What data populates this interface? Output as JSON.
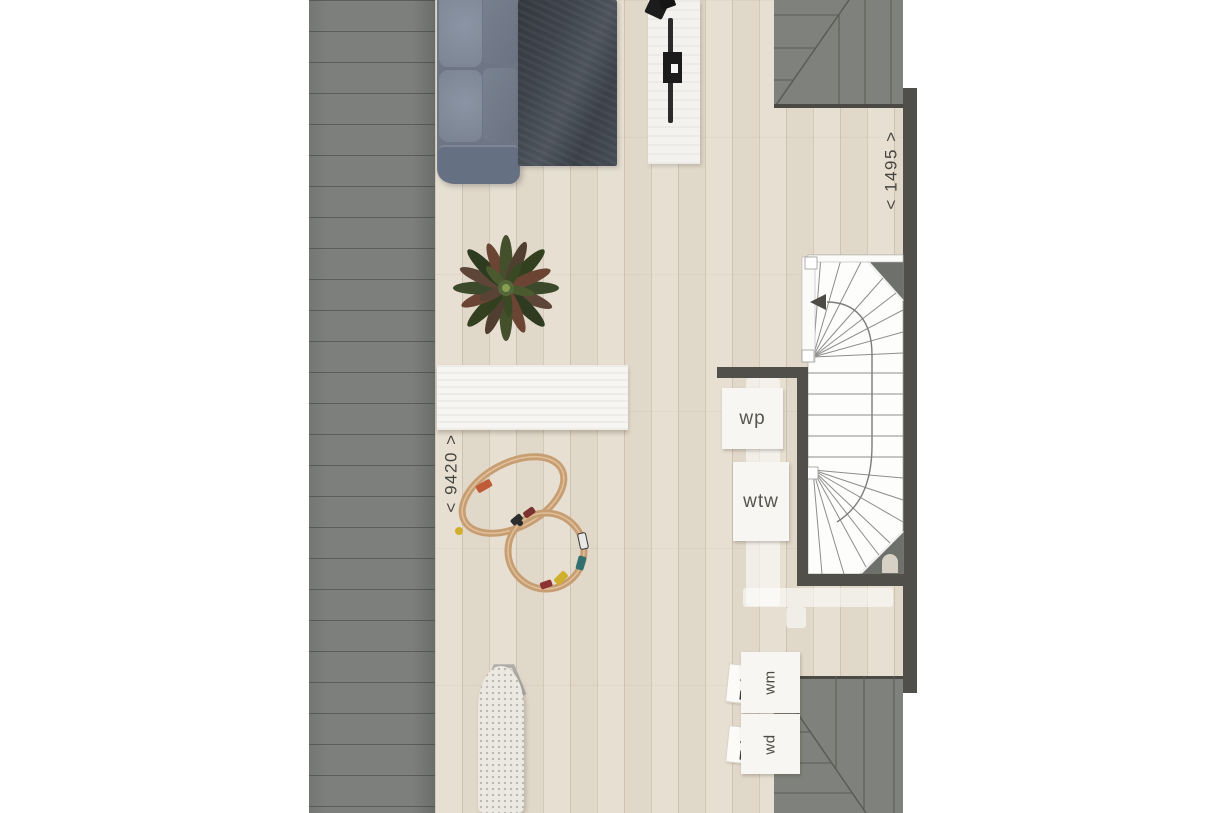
{
  "plan": {
    "dimension_labels": {
      "width": "< 9420 >",
      "depth": "< 1495 >"
    },
    "unit_labels": {
      "wp": "wp",
      "wtw": "wtw",
      "wm": "wm",
      "wd": "wd"
    },
    "colors": {
      "roof_gray": "#7c7f7b",
      "roof_seam": "#5c5f59",
      "wall_dark": "#504f49",
      "floor_wood": "#e6ded0",
      "stair_white": "#fdfdfc",
      "stair_chamfer": "#6e716b",
      "duct_overlay": "rgba(255,255,255,0.55)",
      "sofa_gray_blue": "#6e7686",
      "rug_charcoal": "#3d434b",
      "label_text": "#45443f"
    }
  }
}
